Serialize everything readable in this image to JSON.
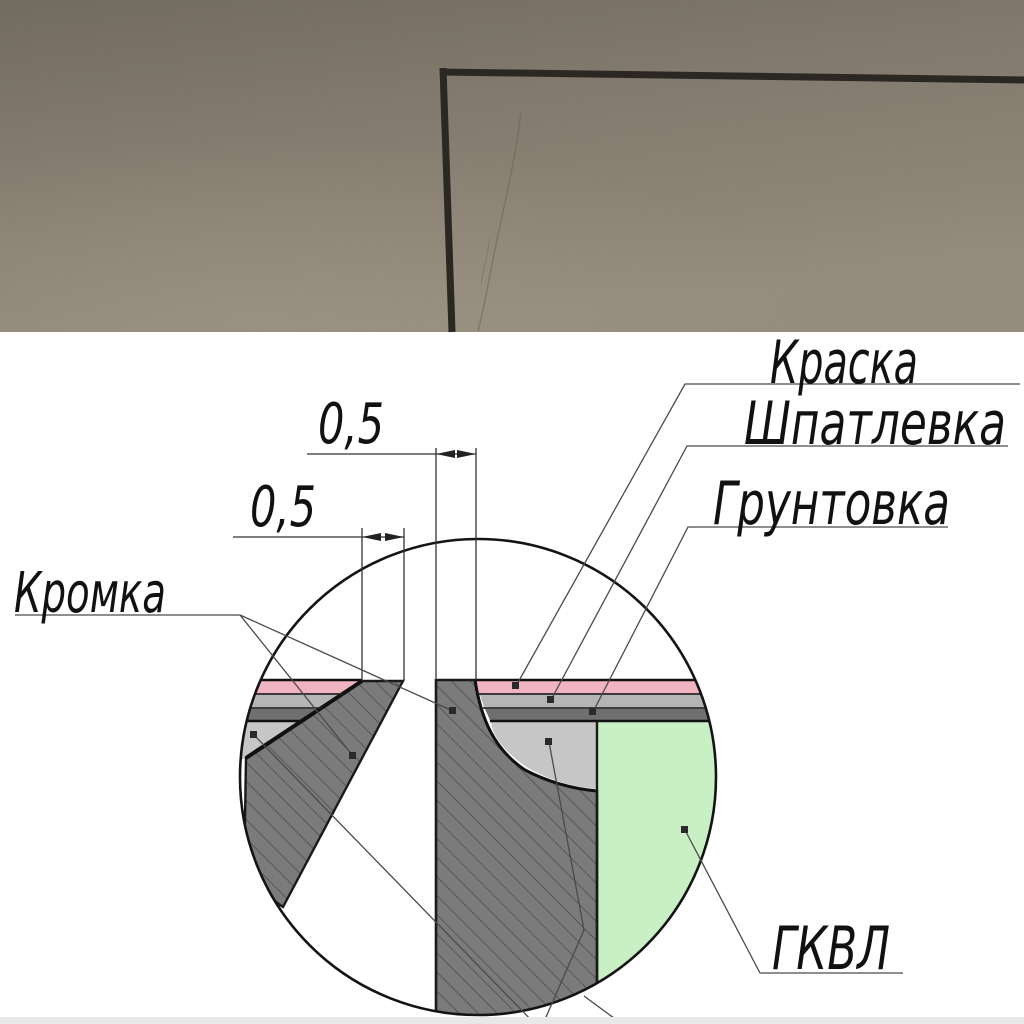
{
  "photo": {
    "colors": {
      "wall_top": "#787164",
      "wall_mid": "#8a8275",
      "wall_bottom": "#9d9484",
      "corner_line": "#2b2722",
      "crack": "#6b6254"
    }
  },
  "diagram": {
    "dimensions": {
      "top_gap": "0,5",
      "bottom_gap": "0,5"
    },
    "labels": {
      "paint": "Краска",
      "putty": "Шпатлевка",
      "primer": "Грунтовка",
      "edge": "Кромка",
      "board": "ГКВЛ"
    },
    "colors": {
      "paint": "#f0b4c0",
      "putty_layer": "#b5b5b5",
      "primer_layer": "#6f6f6f",
      "filler": "#c6c6c6",
      "board_core": "#c9efc5",
      "board_edge": "#7b7b7b",
      "hatch_line": "#4d4d4d",
      "outline": "#1a1a1a",
      "footer_strip": "#e8e8e8"
    }
  }
}
